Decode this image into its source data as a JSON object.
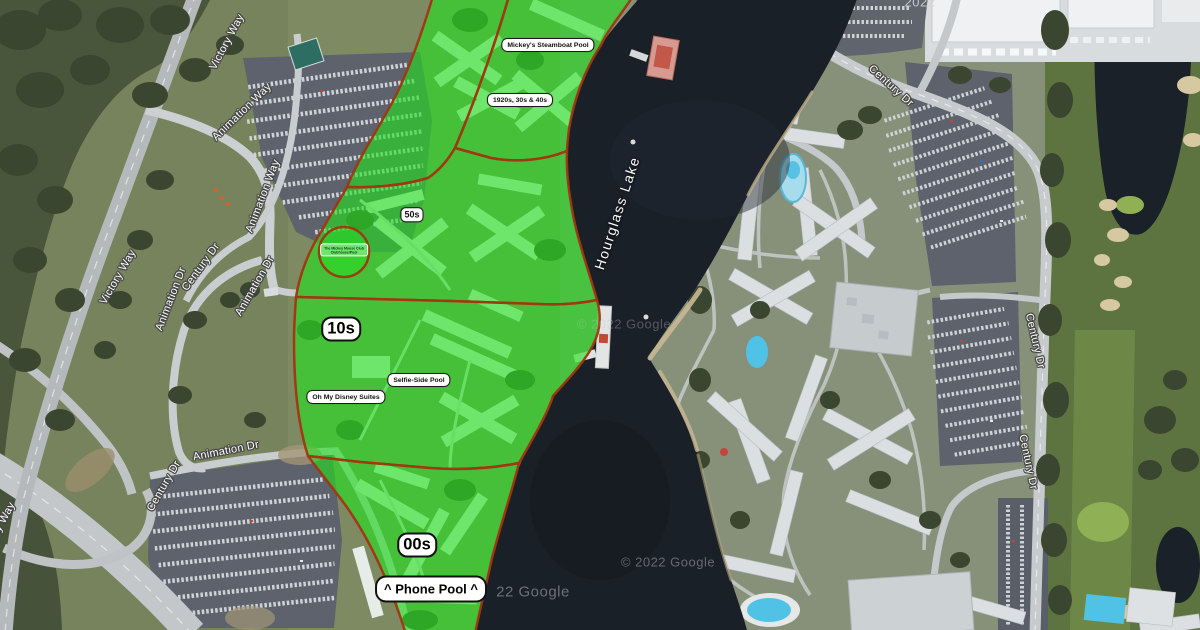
{
  "area_labels": {
    "mickeys_pool": "Mickey's Steamboat Pool",
    "decades_1920s": "1920s, 30s & 40s",
    "fifties": "50s",
    "tens": "10s",
    "selfie_pool": "Selfie-Side Pool",
    "oh_my_suites": "Oh My Disney Suites",
    "zeros": "00s",
    "phone_pool": "^ Phone Pool ^",
    "clubhouse_line1": "The Mickey Mouse Club",
    "clubhouse_line2": "Clubhouse/Pool"
  },
  "water_label": "Hourglass Lake",
  "road_labels": [
    "Victory Way",
    "Animation Way",
    "Animation Way",
    "Victory Way",
    "Animation Dr",
    "Century Dr",
    "Animation Dr",
    "Animation Dr",
    "Century Dr",
    "Victory Way",
    "Century Dr",
    "Century Dr",
    "Century Dr"
  ],
  "watermarks": [
    "© 2022 Google",
    "© 2022 Google",
    "22 Google",
    "2022"
  ],
  "colors": {
    "highlight_green": "#24e01f",
    "zone_border": "#a23512",
    "lake": "#1a2027",
    "label_bg": "#ffffff",
    "label_text": "#111111"
  }
}
